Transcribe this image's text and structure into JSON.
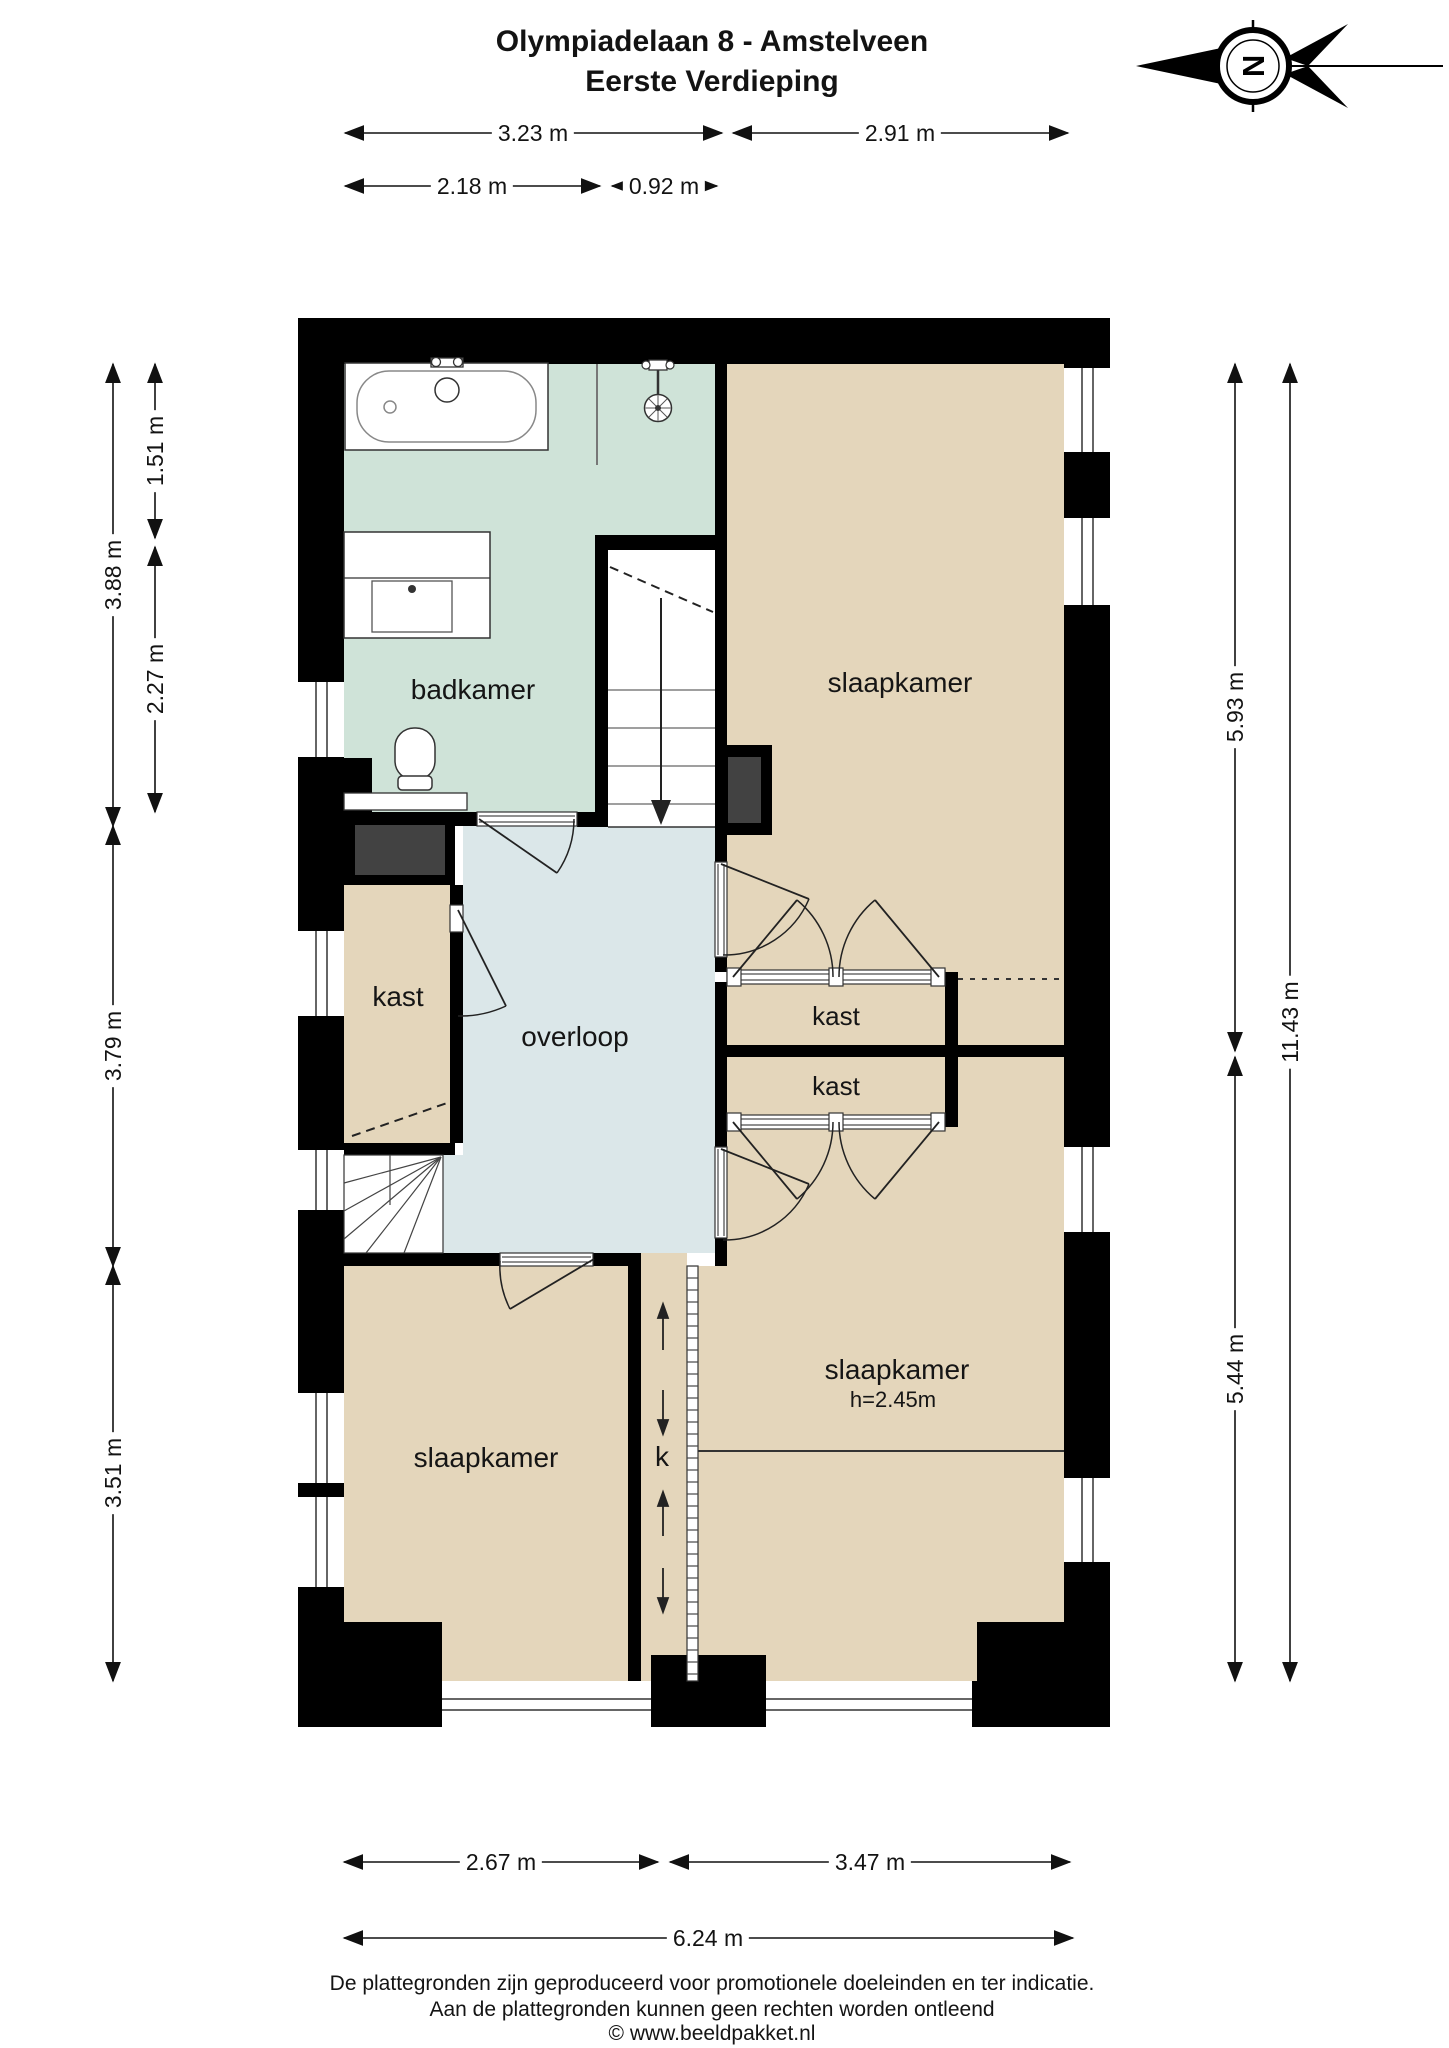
{
  "title": {
    "line1": "Olympiadelaan 8 - Amstelveen",
    "line2": "Eerste Verdieping"
  },
  "compass": {
    "letter": "N"
  },
  "rooms": {
    "badkamer": "badkamer",
    "slaapkamer_top": "slaapkamer",
    "kast_left": "kast",
    "overloop": "overloop",
    "kast_mid_top": "kast",
    "kast_mid_bottom": "kast",
    "slaapkamer_right": "slaapkamer",
    "slaapkamer_right_height": "h=2.45m",
    "slaapkamer_bottom_left": "slaapkamer",
    "k_closet": "k"
  },
  "dimensions": {
    "top_row1": [
      "3.23 m",
      "2.91 m"
    ],
    "top_row2": [
      "2.18 m",
      "0.92 m"
    ],
    "left_outer": [
      "3.88 m",
      "3.79 m",
      "3.51 m"
    ],
    "left_inner": [
      "1.51 m",
      "2.27 m"
    ],
    "right_inner": [
      "5.93 m",
      "5.44 m"
    ],
    "right_outer": [
      "11.43 m"
    ],
    "bottom_row1": [
      "2.67 m",
      "3.47 m"
    ],
    "bottom_row2": [
      "6.24 m"
    ]
  },
  "footer": {
    "line1": "De plattegronden zijn geproduceerd voor promotionele doeleinden en ter indicatie.",
    "line2": "Aan de plattegronden kunnen geen rechten worden ontleend",
    "line3": "© www.beeldpakket.nl"
  },
  "colors": {
    "bathroom": "#cfe3d8",
    "bedroom": "#e4d6bb",
    "hallway": "#dbe7e9",
    "wall": "#000000",
    "shaft": "#424242"
  }
}
